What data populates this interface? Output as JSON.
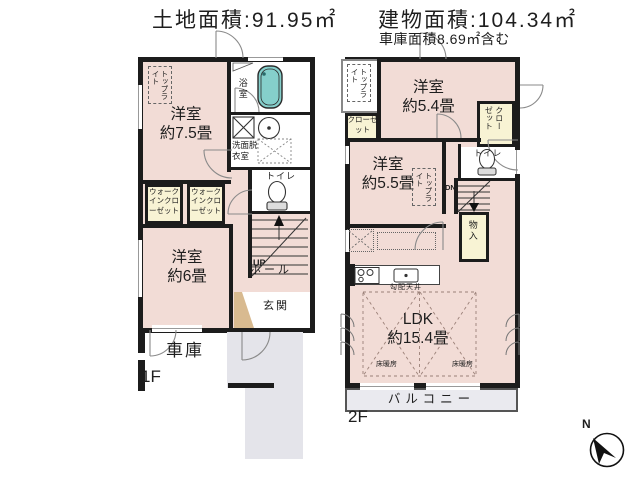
{
  "header": {
    "land_area": "土地面積:91.95㎡",
    "building_area": "建物面積:104.34㎡",
    "garage_area_note": "車庫面積8.69㎡含む"
  },
  "floor1": {
    "label": "1F",
    "bedroom_75": {
      "name": "洋室",
      "size": "約7.5畳"
    },
    "bedroom_6": {
      "name": "洋室",
      "size": "約6畳"
    },
    "bath": "浴室",
    "washroom": "洗面脱衣室",
    "toilet": "トイレ",
    "hall": "ホール",
    "entrance": "玄関",
    "garage": "車庫",
    "walk_in_closet_1": "ウォークインクローゼット",
    "walk_in_closet_2": "ウォークインクローゼット",
    "skylight": "トップライト",
    "stairs": "UP"
  },
  "floor2": {
    "label": "2F",
    "bedroom_54": {
      "name": "洋室",
      "size": "約5.4畳"
    },
    "bedroom_55": {
      "name": "洋室",
      "size": "約5.5畳"
    },
    "ldk": {
      "name": "LDK",
      "size": "約15.4畳"
    },
    "toilet": "トイレ",
    "closet_left": "クローゼット",
    "closet_right": "クローゼット",
    "storage": "物入",
    "balcony": "バルコニー",
    "sloped_ceiling": "勾配天井",
    "floor_heating_1": "床暖房",
    "floor_heating_2": "床暖房",
    "skylight_stairwell": "トップライト",
    "skylight_room": "トップライト",
    "stairs": "DN"
  },
  "compass": {
    "label": "N"
  },
  "colors": {
    "wall": "#1c1c1c",
    "room_floor": "#f2dcd6",
    "closet_floor": "#f8f3d4",
    "bathtub": "#85cfcb",
    "exterior_gray": "#e4e4ea",
    "entrance_step": "#d8ba90"
  }
}
